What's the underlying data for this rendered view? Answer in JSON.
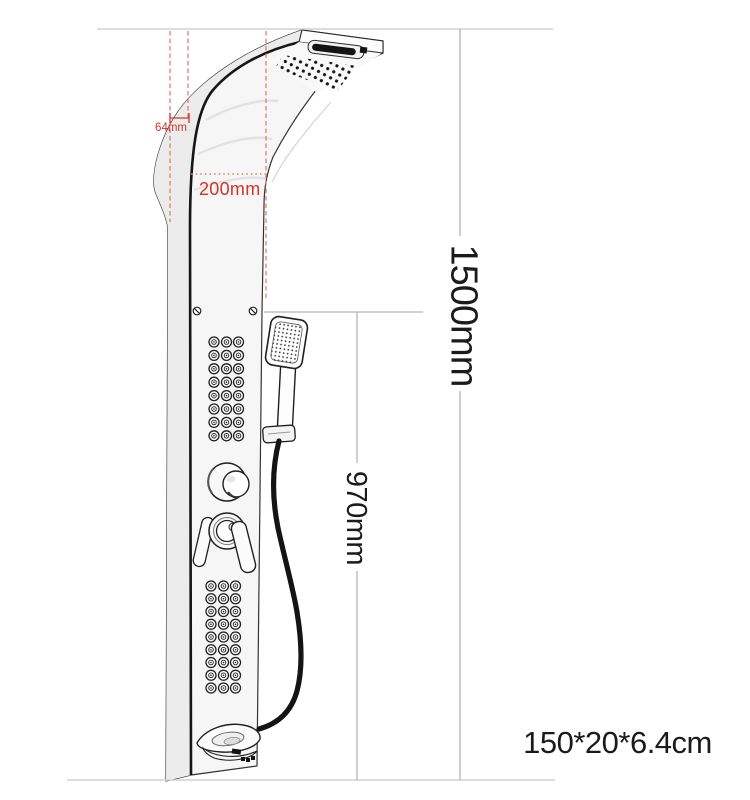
{
  "diagram": {
    "title": "shower panel dimension diagram",
    "dimensions": {
      "overhang": "64mm",
      "head_depth": "200mm",
      "total_height": "1500mm",
      "hand_shower_height": "970mm",
      "overall_size": "150*20*6.4cm"
    },
    "colors": {
      "dimension_text_red": "#d2342a",
      "dimension_dash_red": "#e07468",
      "dimension_dot_red": "#e08379",
      "dimension_line_gray": "#b5b5b5",
      "reference_line_gray": "#d2d2d2",
      "ink": "#1b1b1b",
      "background": "#ffffff"
    }
  },
  "illustration": {
    "upper_body_jets": {
      "cols": [
        214,
        226.5,
        238.5
      ],
      "row_start": 342,
      "row_step": 13.4,
      "rows": 8
    },
    "lower_body_jets": {
      "cols": [
        211,
        223.5,
        235.5
      ],
      "row_start": 586,
      "row_step": 12.75,
      "rows": 9
    }
  }
}
